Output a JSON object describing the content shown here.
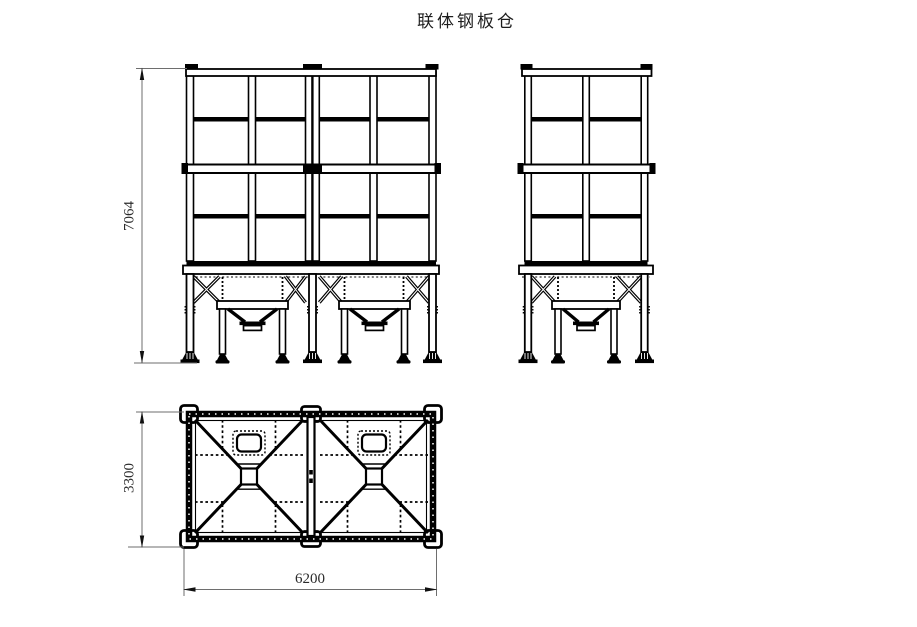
{
  "title": "联体钢板仓",
  "dimensions": {
    "overall_height": "7064",
    "plan_depth": "3300",
    "plan_width": "6200"
  }
}
